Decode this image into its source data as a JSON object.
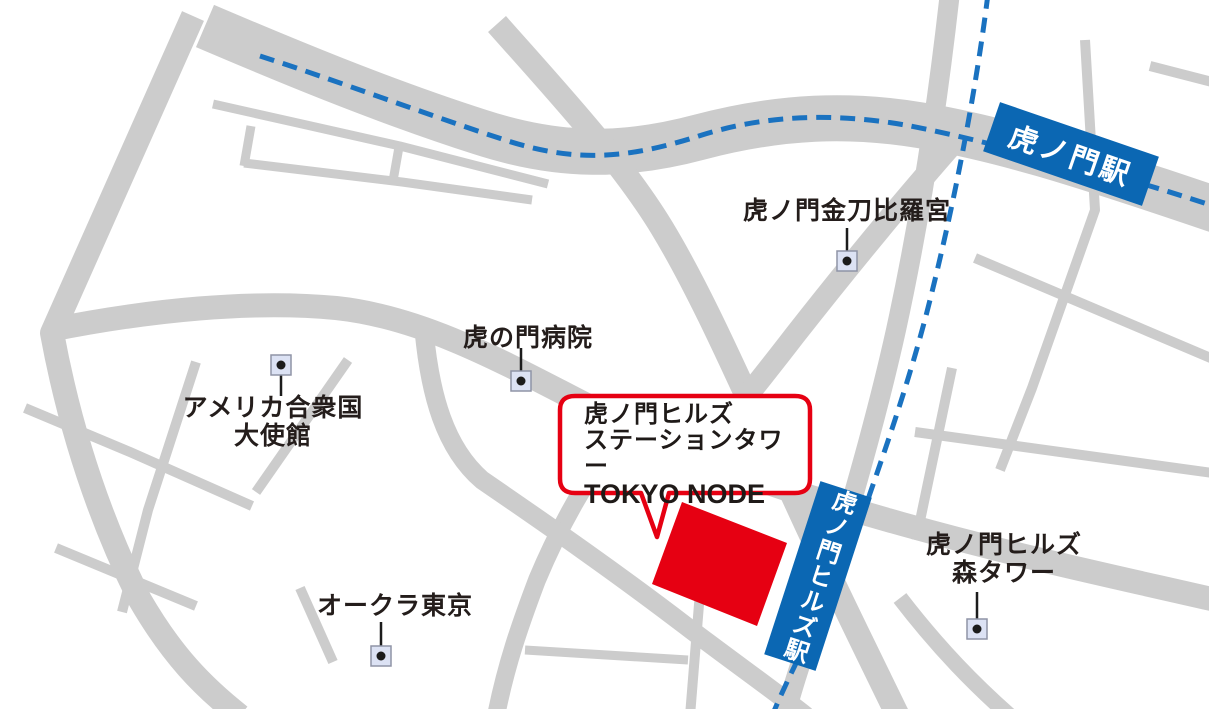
{
  "colors": {
    "road": "#cccccc",
    "rail_blue": "#1a72c0",
    "station_blue": "#0b67b3",
    "accent_red": "#e60012",
    "label_text": "#241d1b",
    "marker_fill": "#dce2f4",
    "marker_border": "#8f94a6",
    "marker_dot": "#1c1c1c",
    "background": "#ffffff"
  },
  "stations": {
    "toranomon": {
      "label": "虎ノ門駅"
    },
    "hills": {
      "label": "虎ノ門ヒルズ駅"
    }
  },
  "places": {
    "kotohira": {
      "label": "虎ノ門金刀比羅宮"
    },
    "hospital": {
      "label": "虎の門病院"
    },
    "embassy": {
      "line1": "アメリカ合衆国",
      "line2": "大使館"
    },
    "okura": {
      "label": "オークラ東京"
    },
    "mori": {
      "line1": "虎ノ門ヒルズ",
      "line2": "森タワー"
    }
  },
  "callout": {
    "line1": "虎ノ門ヒルズ",
    "line2": "ステーションタワー",
    "line3": "TOKYO NODE"
  }
}
